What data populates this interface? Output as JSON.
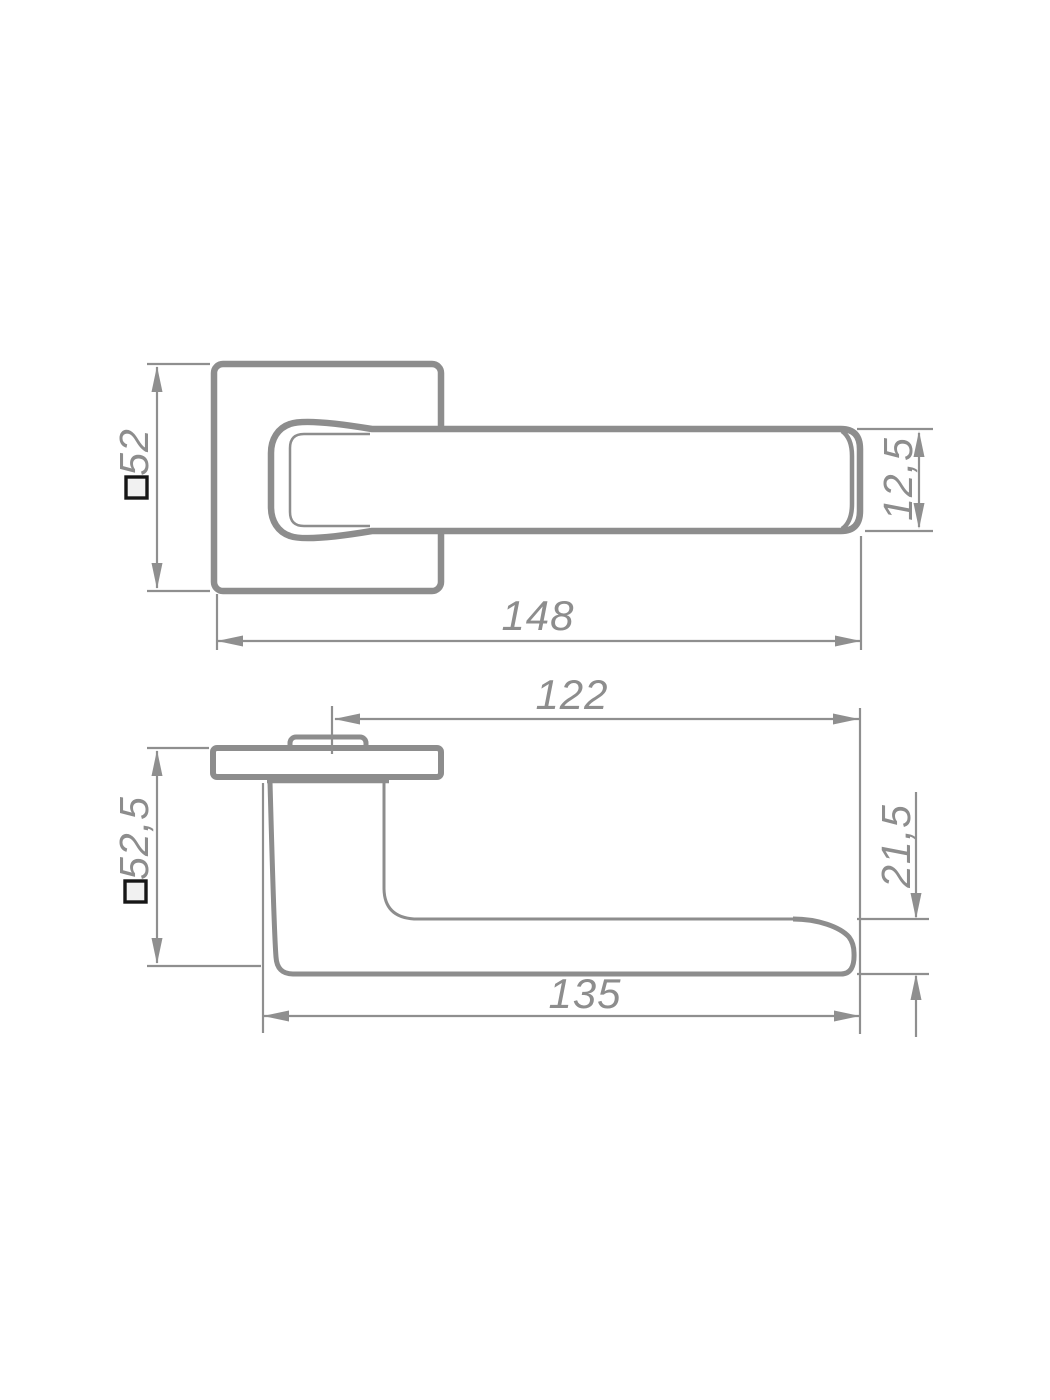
{
  "drawing": {
    "subject": "door-handle-on-square-rosette",
    "colors": {
      "line_gray": "#8d8d8d",
      "dimension_gray": "#8f8f8f",
      "square_symbol_black": "#161616",
      "background": "#ffffff"
    },
    "front_view": {
      "rosette_size": {
        "prefix": "□",
        "value": "52"
      },
      "overall_length": {
        "value": "148"
      },
      "lever_thickness": {
        "value": "12,5"
      }
    },
    "side_view": {
      "lever_projection": {
        "value": "122"
      },
      "rosette_size": {
        "prefix": "□",
        "value": "52,5"
      },
      "lever_height": {
        "value": "21,5"
      },
      "grip_length": {
        "value": "135"
      }
    }
  }
}
